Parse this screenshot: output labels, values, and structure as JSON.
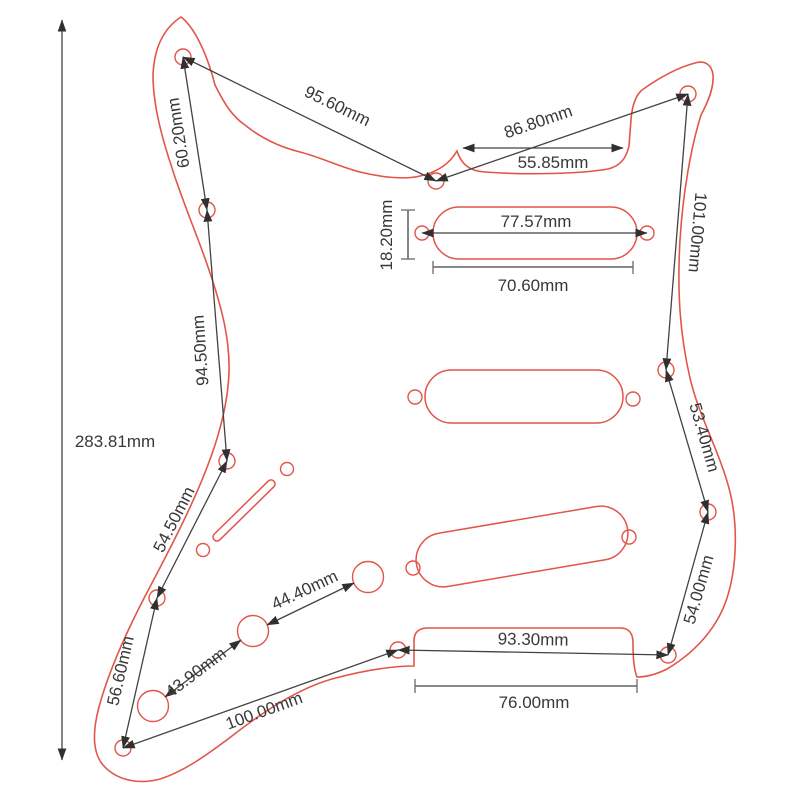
{
  "diagram": {
    "type": "technical-dimension-drawing",
    "subject": "guitar pickguard (SSS Strat style) with screw holes, pickup cutouts, potentiometer holes and switch slot",
    "unit": "mm",
    "colors": {
      "outline": "#e25549",
      "dimension_lines": "#424242",
      "label_text": "#383838",
      "background": "#ffffff"
    },
    "features": {
      "edge_screw_holes": 11,
      "pickup_cutouts": 3,
      "pickup_screw_holes": 6,
      "pot_holes": 3,
      "switch_slot": 1,
      "switch_screw_holes": 2
    },
    "labels": {
      "overall_height": "283.81mm",
      "horn_to_neck_diagonal": "95.60mm",
      "neck_to_top_right_diagonal": "86.80mm",
      "neck_pocket_width": "55.85mm",
      "upper_horn_screws": "60.20mm",
      "left_upper_screws": "94.50mm",
      "left_mid_screws": "54.50mm",
      "left_lower_screws": "56.60mm",
      "right_upper_screws": "101.00mm",
      "right_mid_screws": "53.40mm",
      "right_lower_screws": "54.00mm",
      "pickup_height": "18.20mm",
      "pickup_screw_span": "77.57mm",
      "pickup_length": "70.60mm",
      "bridge_screw_span": "93.30mm",
      "bridge_notch_width": "76.00mm",
      "bottom_diagonal": "100.00mm",
      "pot_spacing_1": "43.90mm",
      "pot_spacing_2": "44.40mm"
    }
  }
}
